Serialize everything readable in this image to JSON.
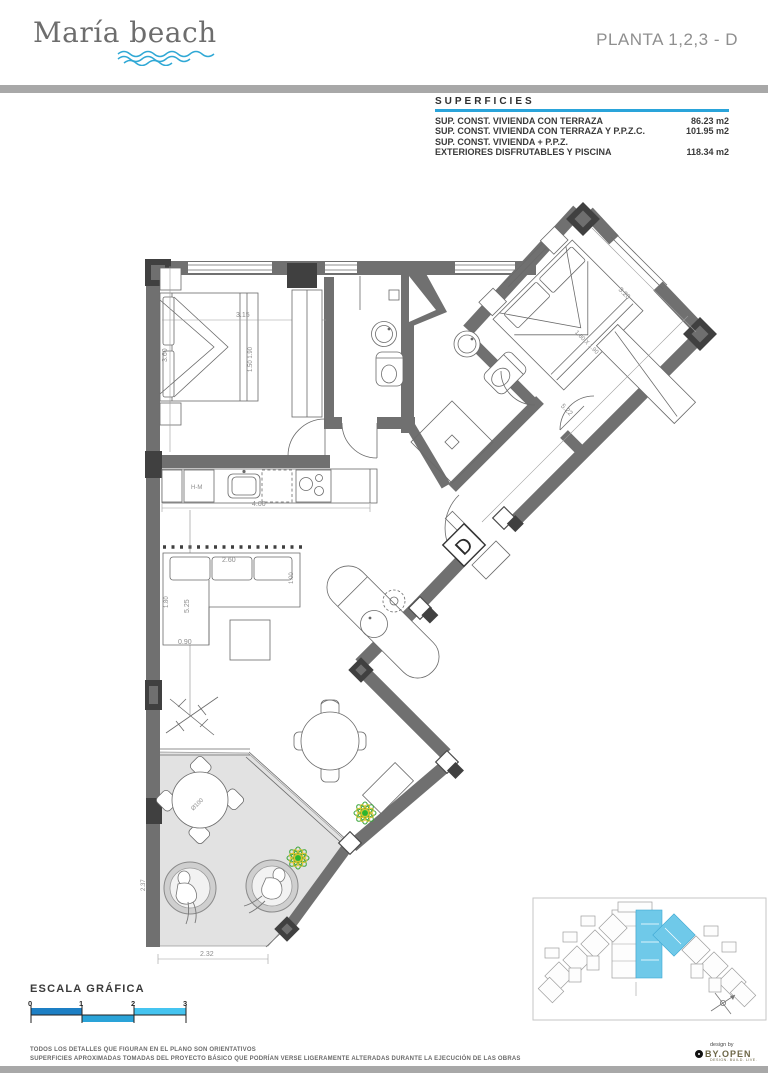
{
  "header": {
    "logo": "María beach",
    "plan_title": "PLANTA 1,2,3 - D"
  },
  "superficies": {
    "title": "SUPERFICIES",
    "rows": [
      {
        "label": "SUP. CONST. VIVIENDA  CON TERRAZA",
        "value": "86.23 m2"
      },
      {
        "label": "SUP. CONST. VIVIENDA CON TERRAZA Y P.P.Z.C.",
        "value": "101.95 m2"
      },
      {
        "label": "SUP. CONST. VIVIENDA + P.P.Z.",
        "value": ""
      },
      {
        "label": "EXTERIORES DISFRUTABLES Y PISCINA",
        "value": "118.34 m2"
      }
    ]
  },
  "plan": {
    "unit_letter": "D",
    "labels": {
      "appliance": "H-M",
      "table_diameter": "Ø100"
    },
    "dims": {
      "bedroom2_width": "3.15",
      "bedroom2_depth": "3.60",
      "bed2_size": "1.50 1.90",
      "master_width": "3.20",
      "master_bed": "1.80 X 1.90",
      "master_length": "5.22",
      "kitchen_width": "4.00",
      "sofa_width": "2.60",
      "sofa_depth": "1.00",
      "chaise_depth": "1.80",
      "living_depth": "5.25",
      "chaise_width": "0.90",
      "terrace_height": "2.37",
      "terrace_width": "2.32"
    }
  },
  "scale_bar": {
    "title": "ESCALA GRÁFICA",
    "ticks": [
      "0",
      "1",
      "2",
      "3"
    ]
  },
  "footer": {
    "disclaimer_line1": "TODOS LOS DETALLES QUE FIGURAN EN EL PLANO SON ORIENTATIVOS",
    "disclaimer_line2": "SUPERFICIES APROXIMADAS TOMADAS DEL PROYECTO BÁSICO QUE PODRÍAN VERSE LIGERAMENTE ALTERADAS DURANTE LA EJECUCIÓN DE LAS OBRAS",
    "design_by": "design by",
    "brand": "BY.OPEN",
    "brand_sub": "DESIGN. BUILD. LIVE."
  },
  "colors": {
    "accent_blue": "#2aa4da",
    "wall_gray": "#707070",
    "terrace_gray": "#e2e2e2",
    "highlight_cyan": "#6fc9e9"
  }
}
